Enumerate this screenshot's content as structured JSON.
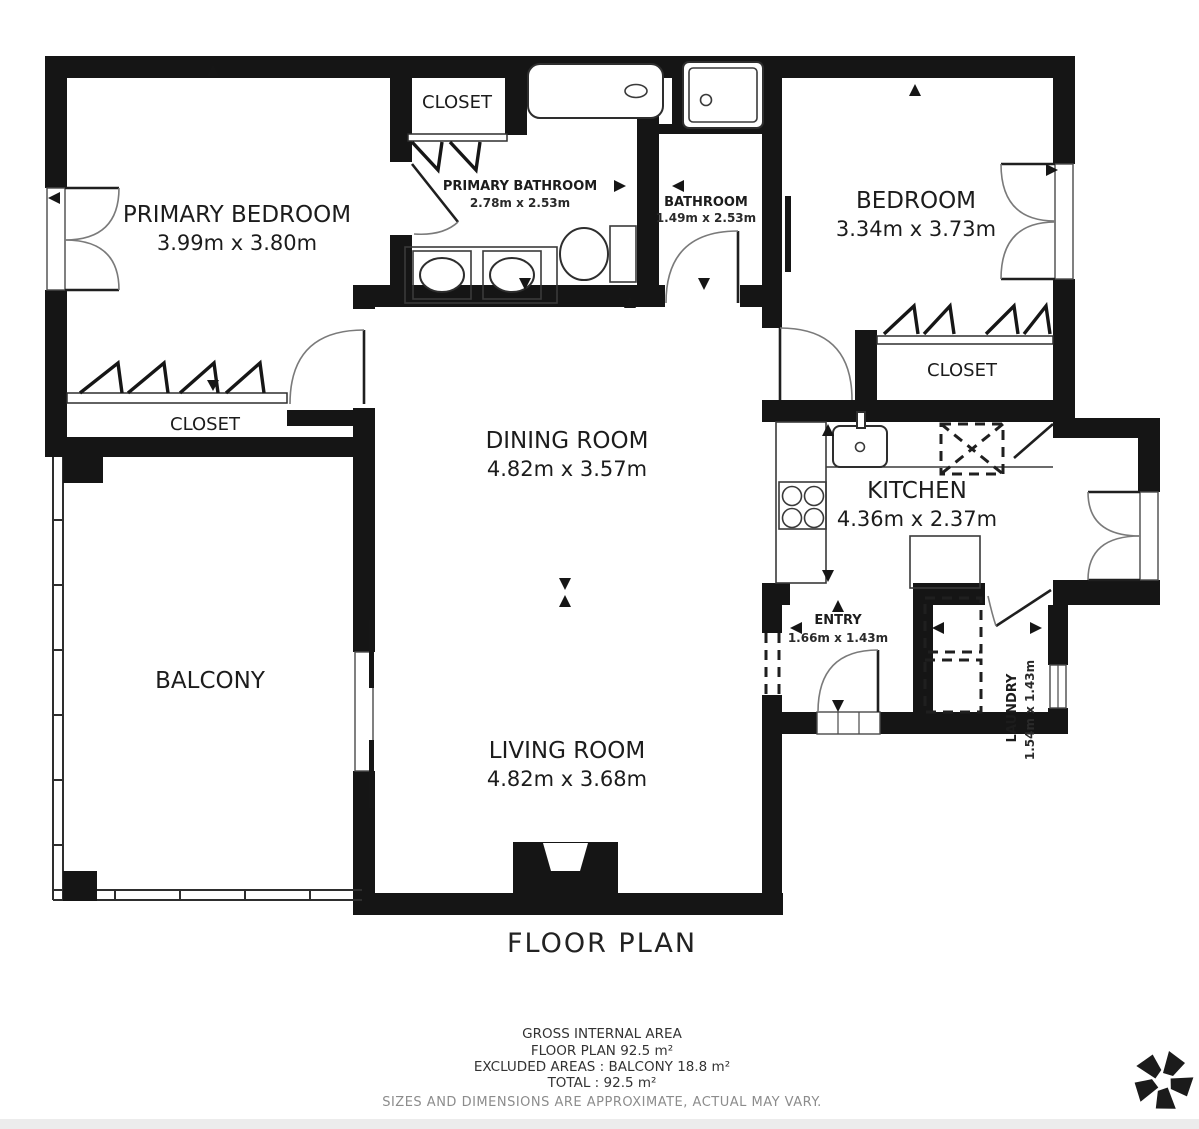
{
  "meta": {
    "title": "FLOOR PLAN"
  },
  "rooms": {
    "primary_bedroom": {
      "name": "PRIMARY BEDROOM",
      "dims": "3.99m x 3.80m"
    },
    "closet_top": {
      "name": "CLOSET"
    },
    "primary_bathroom": {
      "name": "PRIMARY BATHROOM",
      "dims": "2.78m x 2.53m"
    },
    "bathroom": {
      "name": "BATHROOM",
      "dims": "1.49m x 2.53m"
    },
    "bedroom": {
      "name": "BEDROOM",
      "dims": "3.34m x 3.73m"
    },
    "closet_right": {
      "name": "CLOSET"
    },
    "closet_left": {
      "name": "CLOSET"
    },
    "dining_room": {
      "name": "DINING ROOM",
      "dims": "4.82m x 3.57m"
    },
    "kitchen": {
      "name": "KITCHEN",
      "dims": "4.36m x 2.37m"
    },
    "balcony": {
      "name": "BALCONY"
    },
    "living_room": {
      "name": "LIVING ROOM",
      "dims": "4.82m x 3.68m"
    },
    "entry": {
      "name": "ENTRY",
      "dims": "1.66m x 1.43m"
    },
    "laundry": {
      "name": "LAUNDRY",
      "dims": "1.54m x 1.43m"
    }
  },
  "footer": {
    "line1": "GROSS INTERNAL AREA",
    "line2": "FLOOR PLAN 92.5 m²",
    "line3": "EXCLUDED AREAS :  BALCONY 18.8 m²",
    "line4": "TOTAL :  92.5 m²",
    "disclaimer": "SIZES AND DIMENSIONS ARE APPROXIMATE, ACTUAL MAY VARY."
  },
  "colors": {
    "wall": "#151515",
    "text": "#1c1c1c",
    "muted": "#8c8c8c",
    "bg": "#ffffff"
  }
}
